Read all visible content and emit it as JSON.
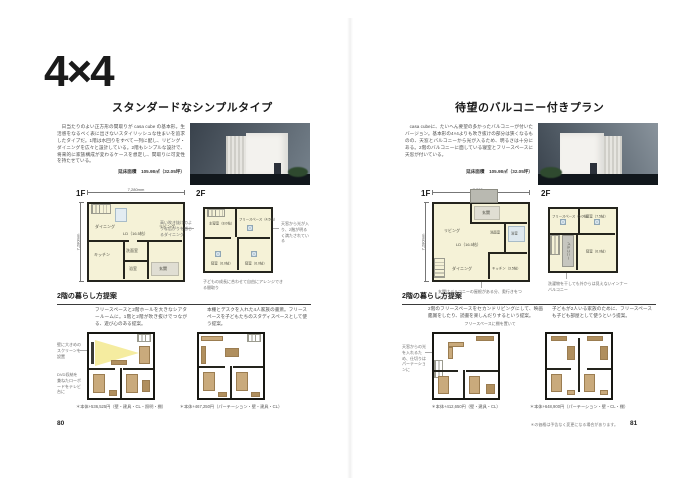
{
  "spread": {
    "left": {
      "page_number": "80",
      "title": "4×4",
      "subtitle": "スタンダードなシンプルタイプ",
      "intro": "日当たりのよい正方形の間取りが casa cube の基本形。生活感をなるべく表に出さないスタイリッシュな住まいを追求したタイプだ。1階は水回りをすべて一列に配し、リビング・ダイニングを広々と設計している。2階もシンプルな設計で、将来的に家族構成が変わるケースを想定し、間取りに可変性を持たせている。",
      "floor_area": "延床面積　105.98㎡（32.05坪）",
      "plans": {
        "f1": {
          "label": "1F",
          "dim_top": "7,280mm",
          "dim_side": "7,280mm",
          "rooms": [
            "ダイニング",
            "LD（16.5帖）",
            "リビング",
            "キッチン",
            "洗面室",
            "浴室",
            "玄関"
          ],
          "note": "高い吹き抜けのような広がりを感じるダイニング"
        },
        "f2": {
          "label": "2F",
          "rooms": [
            "主寝室（8.0帖）",
            "フリースペース（4.5帖）",
            "寝室（6.0帖）",
            "寝室（6.0帖）"
          ],
          "note_right": "天窓から光が入り、2階が明るく満たされている",
          "note_bottom": "子どもの成長に合わせて自由にアレンジできる間取り"
        }
      },
      "proposal": {
        "heading": "2階の暮らし方提案",
        "a": {
          "text": "フリースペースと2階ホールを大きなシアタールームに。1階と2階が吹き抜けでつながる、遊び心のある提案。",
          "note1": "壁に大きめのスクリーンを設置",
          "note2": "DVD収納を兼ねたローボードをテレビ台に",
          "caption": "＊本体+536,525円（壁・建具・CL・照明・棚）"
        },
        "b": {
          "text": "本棚とデスクを入れた4人家族の書斎。フリースペースを子どもたちのスタディスペースとして使う提案。",
          "caption": "＊本体+467,250円（パーテーション・壁・建具・CL）"
        }
      }
    },
    "right": {
      "page_number": "81",
      "subtitle": "待望のバルコニー付きプラン",
      "intro": "casa cubeに、たいへん要望の多かったバルコニーが付いたバージョン。基本形の4×4よりも吹き抜けの部分は狭くなるものの、天窓とバルコニーから光が入るため、明るさは十分にある。2階のバルコニーに面している寝室とフリースペースに天窓が付いている。",
      "floor_area": "延床面積　105.98㎡（32.05坪）",
      "plans": {
        "f1": {
          "label": "1F",
          "dim_top": "7,280mm",
          "dim_side": "7,280mm",
          "rooms": [
            "玄関",
            "リビング",
            "LD（16.5帖）",
            "洗面室",
            "浴室",
            "ダイニング",
            "キッチン（3.5帖）"
          ],
          "note": "玄関はバルコニーの屋根がある分、奥行きをつけた"
        },
        "f2": {
          "label": "2F",
          "rooms": [
            "フリースペース（5.0帖）",
            "寝室（7.5帖）",
            "寝室（6.0帖）",
            "バルコニー"
          ],
          "note_bottom": "洗濯物を干しても外からは見えないインナーバルコニー"
        }
      },
      "proposal": {
        "heading": "2階の暮らし方提案",
        "a": {
          "text": "2階のフリースペースをセカンドリビングにして、映画鑑賞をしたり、読書を楽しんだりするという提案。",
          "subnote": "フリースペースに棚を置いて",
          "note1": "天窓からの光を入れるため、仕切りはパーテーションに",
          "caption": "＊本体+412,650円（壁・建具・CL）"
        },
        "b": {
          "text": "子どもが2人いる家族のために、フリースペースも子ども部屋として使うという提案。",
          "caption": "＊本体+648,900円（パーテーション・壁・CL・棚）"
        }
      },
      "footer_note": "＊の価格は予告なく変更になる場合があります。"
    }
  }
}
